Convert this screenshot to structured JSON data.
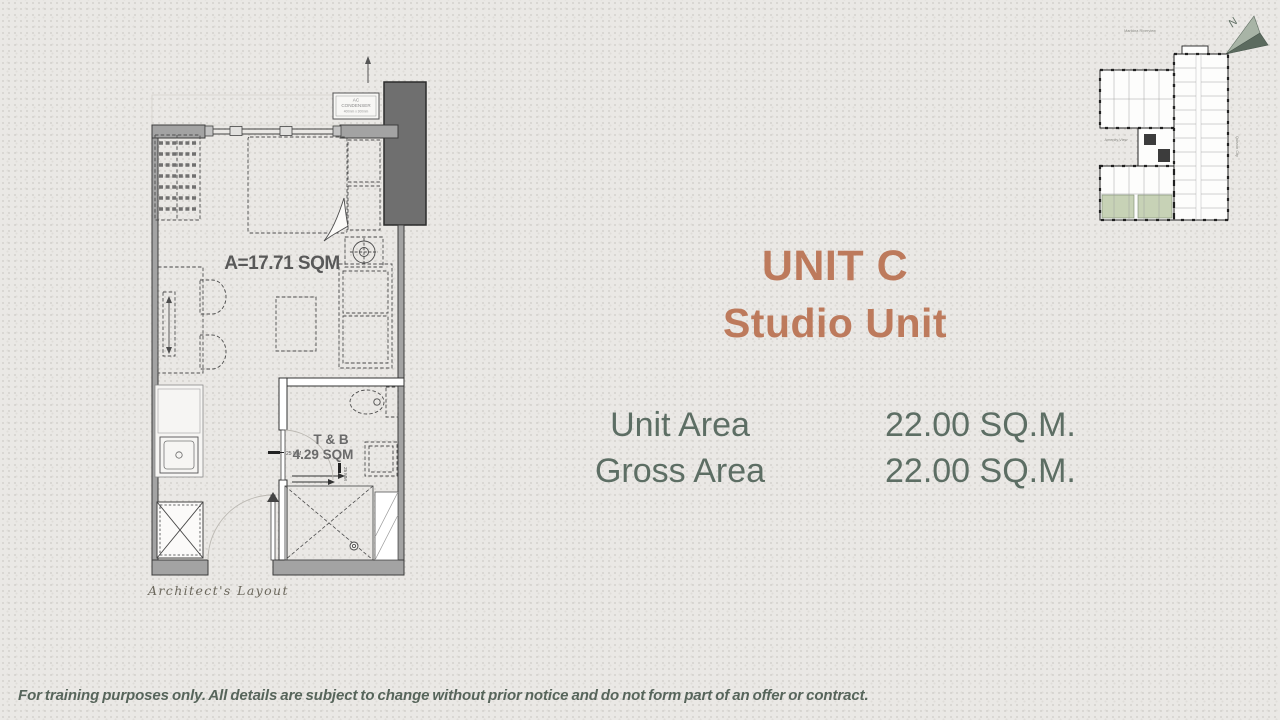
{
  "page": {
    "background_color": "#eae8e5",
    "accent_color": "#bd7a5c",
    "text_color": "#5d6e64",
    "keyplan_highlight_color": "#c7d2b6"
  },
  "header": {
    "title": "UNIT C",
    "subtitle": "Studio Unit"
  },
  "area_table": {
    "rows": [
      {
        "label": "Unit Area",
        "value": "22.00 SQ.M."
      },
      {
        "label": "Gross Area",
        "value": "22.00 SQ.M."
      }
    ]
  },
  "floor_plan": {
    "area_label": "A=17.71 SQM",
    "bath_label_1": "T & B",
    "bath_label_2": "4.29 SQM",
    "ac_label_1": "AC",
    "ac_label_2": "CONDENSER",
    "ac_label_3": "400mm x 300mm",
    "level_note_1": "25 MM",
    "level_note_2": "25 MM",
    "caption": "Architect's Layout"
  },
  "key_plan": {
    "north_label": "N",
    "top_label": "Marikina Riverview",
    "left_label": "Amenity View",
    "right_label": "Quezon City"
  },
  "footer": {
    "disclaimer": "For training purposes only. All details are subject to change without prior notice and do not form part of an offer or contract."
  }
}
